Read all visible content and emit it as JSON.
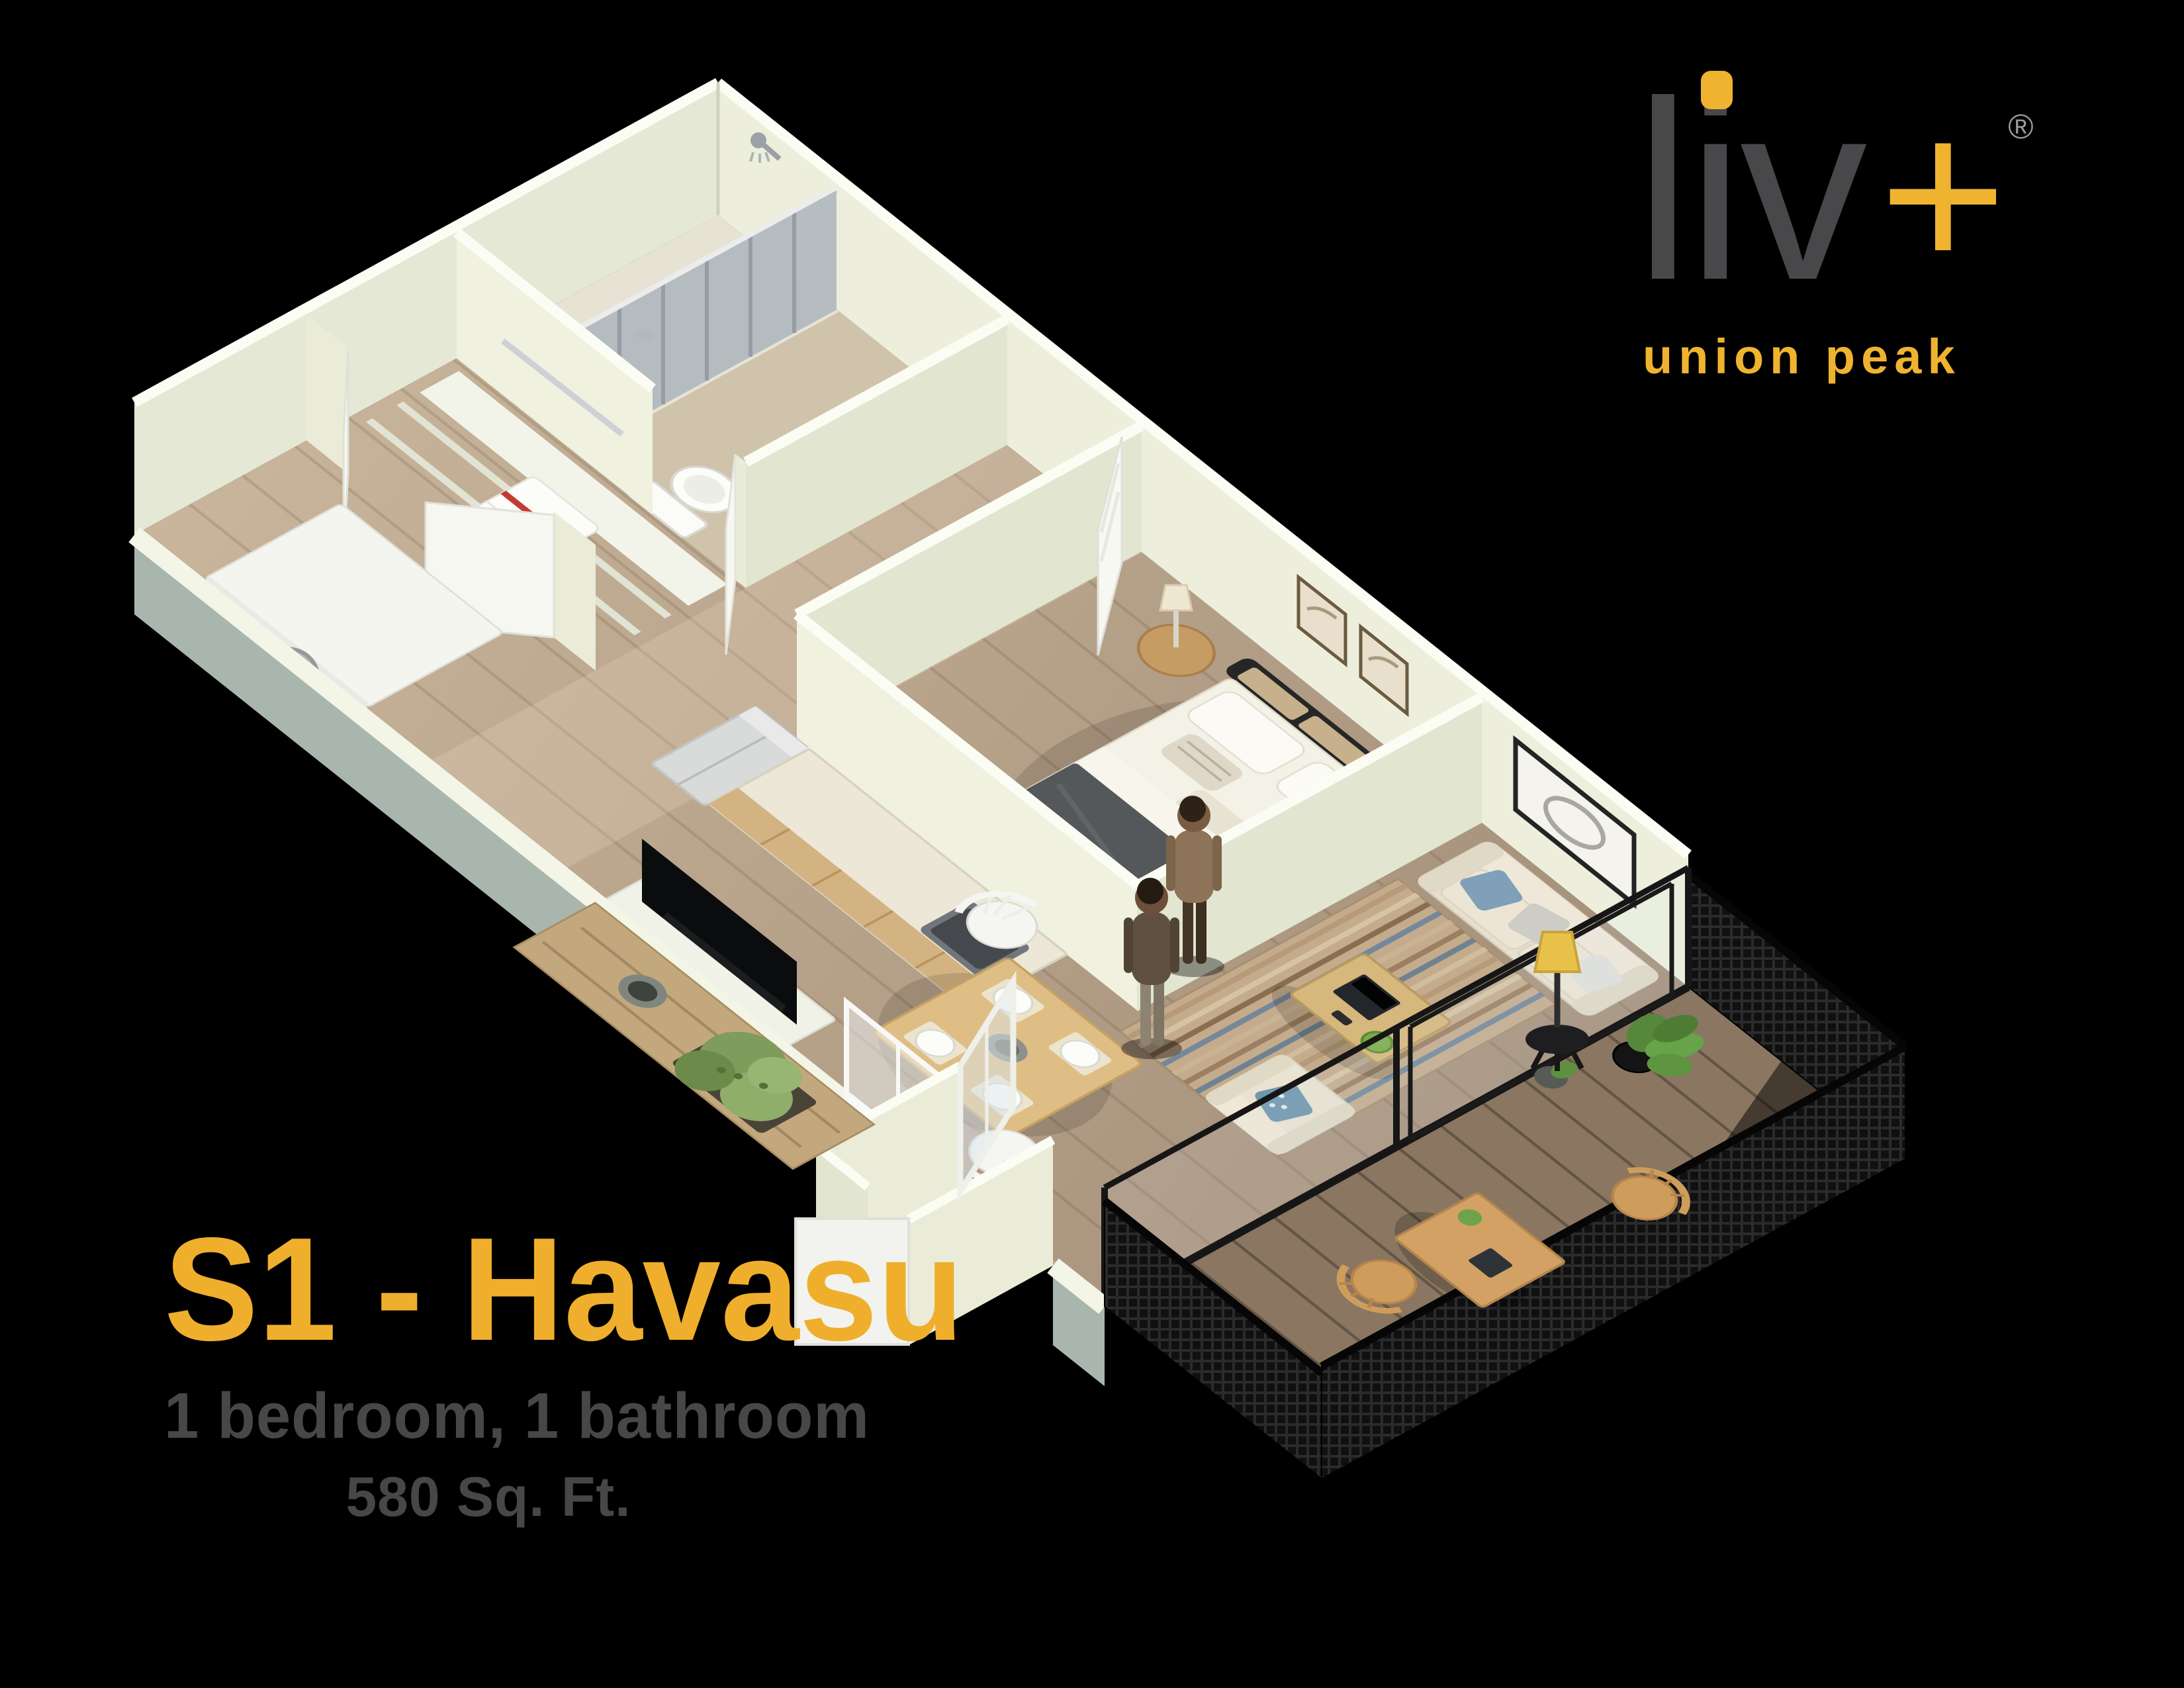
{
  "brand": {
    "name": "liv",
    "plus": "+",
    "registered": "®",
    "tagline": "union peak",
    "logo_gray": "#48484a",
    "gold": "#efb32f"
  },
  "plan": {
    "title": "S1 - Havasu",
    "subtitle": "1 bedroom, 1 bathroom",
    "area": "580 Sq. Ft.",
    "title_color": "#efaf2d",
    "text_color": "#474747"
  },
  "palette": {
    "background": "#000000",
    "wall_face": "#edefdc",
    "wall_cap": "#fbfcf3",
    "wall_exterior": "#a9b6ad",
    "floor_wood": "#b7a189",
    "deck_wood": "#8a7661",
    "screen_mesh": "#121212",
    "sofa_cream": "#e7e0ce",
    "accent_blue": "#7fa0b8",
    "bed_duvet": "#55585b",
    "plant_green": "#6da34b",
    "lamp_yellow": "#e7c14a"
  },
  "scene": {
    "rooms": [
      "bathroom",
      "linen-closet",
      "laundry-closet",
      "bedroom",
      "kitchen",
      "living-room",
      "dining-area",
      "entry",
      "patio"
    ],
    "furniture": [
      "shower",
      "shower-curtain",
      "toilet",
      "vanity",
      "linen-shelves",
      "towel",
      "washer",
      "bed",
      "nightstand",
      "table-lamp",
      "wall-pictures",
      "wall-art",
      "sofa",
      "armchair",
      "coffee-table",
      "laptop",
      "area-rug",
      "floor-lamp",
      "tv",
      "kitchen-counter",
      "sink",
      "fridge",
      "dining-table",
      "dining-chairs",
      "entry-door",
      "desk",
      "desk-chairs",
      "potted-plants",
      "planter-shrub",
      "privacy-screen",
      "two-people"
    ]
  }
}
